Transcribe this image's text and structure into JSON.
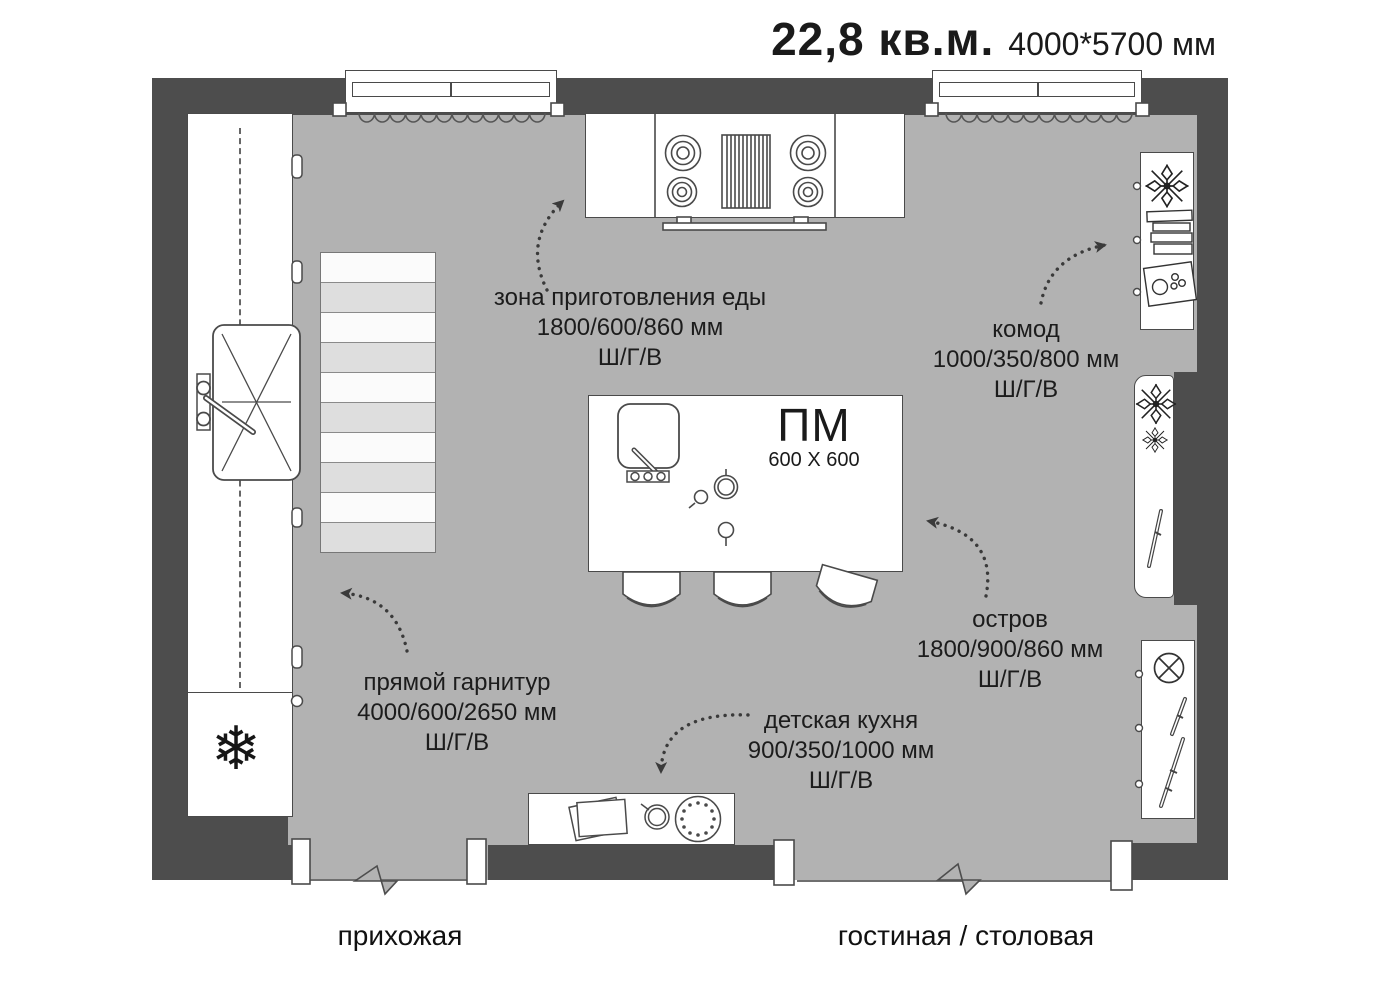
{
  "title": {
    "area": "22,8 кв.м.",
    "size": "4000*5700 мм"
  },
  "rooms": {
    "hallway": "прихожая",
    "living_dining": "гостиная / столовая"
  },
  "island_tag": {
    "name": "ПМ",
    "size": "600 X 600"
  },
  "annotations": {
    "cooking_zone": {
      "name": "зона приготовления еды",
      "size": "1800/600/860 мм",
      "dims_legend": "Ш/Г/В"
    },
    "dresser": {
      "name": "комод",
      "size": "1000/350/800 мм",
      "dims_legend": "Ш/Г/В"
    },
    "island": {
      "name": "остров",
      "size": "1800/900/860 мм",
      "dims_legend": "Ш/Г/В"
    },
    "straight_set": {
      "name": "прямой гарнитур",
      "size": "4000/600/2650 мм",
      "dims_legend": "Ш/Г/В"
    },
    "kids_kitchen": {
      "name": "детская кухня",
      "size": "900/350/1000 мм",
      "dims_legend": "Ш/Г/В"
    }
  },
  "icons": {
    "fridge_glyph": "❄"
  },
  "colors": {
    "wall": "#4d4d4d",
    "floor": "#b2b2b2",
    "rug_stripe": "#dedede",
    "outline": "#4a4a4a",
    "background": "#ffffff"
  }
}
